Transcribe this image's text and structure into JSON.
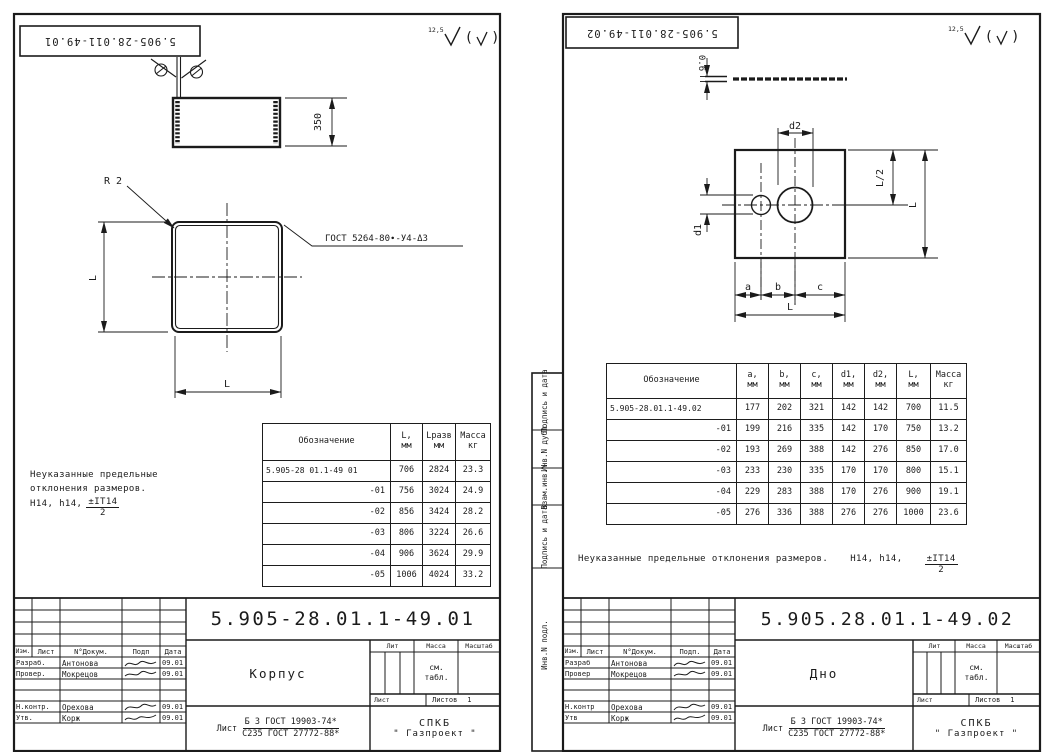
{
  "colors": {
    "ink": "#1b1b1b",
    "paper": "#ffffff"
  },
  "sheet1": {
    "stamp": "5.905-28.011-49.01",
    "roughness_value": "12,5",
    "dims": {
      "side": "350",
      "left": "L",
      "bottom": "L",
      "radius": "R 2"
    },
    "weld_note": "ГОСТ 5264-80∙-У4-Δ3",
    "note": {
      "line1": "Неуказанные предельные",
      "line2": "отклонения размеров.",
      "line3": "Н14, h14,",
      "frac_num": "±IT14",
      "frac_den": "2"
    },
    "table": {
      "headers": [
        {
          "l1": "Обозначение",
          "l2": ""
        },
        {
          "l1": "L,",
          "l2": "мм"
        },
        {
          "l1": "Lразв",
          "l2": "мм"
        },
        {
          "l1": "Масса",
          "l2": "кг"
        }
      ],
      "rows": [
        [
          "5.905-28 01.1-49 01",
          "706",
          "2824",
          "23.3"
        ],
        [
          "-01",
          "756",
          "3024",
          "24.9"
        ],
        [
          "-02",
          "856",
          "3424",
          "28.2"
        ],
        [
          "-03",
          "806",
          "3224",
          "26.6"
        ],
        [
          "-04",
          "906",
          "3624",
          "29.9"
        ],
        [
          "-05",
          "1006",
          "4024",
          "33.2"
        ]
      ]
    },
    "title_block": {
      "doc_number": "5.905-28.01.1-49.01",
      "part_name": "Корпус",
      "cols": [
        "Изм.",
        "Лист",
        "N°Докум.",
        "Подп",
        "Дата"
      ],
      "rows": [
        {
          "role": "Разраб.",
          "name": "Антонова",
          "date": "09.01"
        },
        {
          "role": "Провер.",
          "name": "Мокрецов",
          "date": "09.01"
        },
        {
          "role": "Н.контр.",
          "name": "Орехова",
          "date": "09.01"
        },
        {
          "role": "Утв.",
          "name": "Корж",
          "date": "09.01"
        }
      ],
      "lit": "Лит",
      "mass": "Масса",
      "scale": "Масштаб",
      "mass_value1": "см.",
      "mass_value2": "табл.",
      "sheet": "Лист",
      "sheets": "Листов",
      "sheets_value": "1",
      "material_prefix": "Лист",
      "material1": "Б 3 ГОСТ 19903-74*",
      "material2": "С235 ГОСТ 27772-88*",
      "org1": "СПКБ",
      "org2": "\" Газпроект \""
    }
  },
  "sheet2": {
    "stamp": "5.905-28.011-49.02",
    "roughness_value": "12,5",
    "dims": {
      "thickness": "0.6",
      "d2": "d2",
      "l_half": "L/2",
      "l_right": "L",
      "d1": "d1",
      "a": "a",
      "b": "b",
      "c": "c",
      "l_bottom": "L"
    },
    "note": {
      "text": "Неуказанные предельные отклонения размеров.",
      "tol": "Н14, h14,",
      "frac_num": "±IT14",
      "frac_den": "2"
    },
    "margin_labels": [
      "Подпись и дата",
      "Инв.N дубл",
      "Взам.инв.N",
      "Подпись и дата",
      "Инв.N подл."
    ],
    "table": {
      "headers": [
        {
          "l1": "Обозначение",
          "l2": ""
        },
        {
          "l1": "a,",
          "l2": "мм"
        },
        {
          "l1": "b,",
          "l2": "мм"
        },
        {
          "l1": "c,",
          "l2": "мм"
        },
        {
          "l1": "d1,",
          "l2": "мм"
        },
        {
          "l1": "d2,",
          "l2": "мм"
        },
        {
          "l1": "L,",
          "l2": "мм"
        },
        {
          "l1": "Масса",
          "l2": "кг"
        }
      ],
      "rows": [
        [
          "5.905-28.01.1-49.02",
          "177",
          "202",
          "321",
          "142",
          "142",
          "700",
          "11.5"
        ],
        [
          "-01",
          "199",
          "216",
          "335",
          "142",
          "170",
          "750",
          "13.2"
        ],
        [
          "-02",
          "193",
          "269",
          "388",
          "142",
          "276",
          "850",
          "17.0"
        ],
        [
          "-03",
          "233",
          "230",
          "335",
          "170",
          "170",
          "800",
          "15.1"
        ],
        [
          "-04",
          "229",
          "283",
          "388",
          "170",
          "276",
          "900",
          "19.1"
        ],
        [
          "-05",
          "276",
          "336",
          "388",
          "276",
          "276",
          "1000",
          "23.6"
        ]
      ]
    },
    "title_block": {
      "doc_number": "5.905.28.01.1-49.02",
      "part_name": "Дно",
      "cols": [
        "Изм.",
        "Лист",
        "N°Докум.",
        "Подп.",
        "Дата"
      ],
      "rows": [
        {
          "role": "Разраб",
          "name": "Антонова",
          "date": "09.01"
        },
        {
          "role": "Провер",
          "name": "Мокрецов",
          "date": "09.01"
        },
        {
          "role": "Н.контр",
          "name": "Орехова",
          "date": "09.01"
        },
        {
          "role": "Утв",
          "name": "Корж",
          "date": "09.01"
        }
      ],
      "lit": "Лит",
      "mass": "Масса",
      "scale": "Масштаб",
      "mass_value1": "см.",
      "mass_value2": "табл.",
      "sheet": "Лист",
      "sheets": "Листов",
      "sheets_value": "1",
      "material_prefix": "Лист",
      "material1": "Б 3 ГОСТ 19903-74*",
      "material2": "С235 ГОСТ 27772-88*",
      "org1": "СПКБ",
      "org2": "\" Газпроект \""
    }
  }
}
